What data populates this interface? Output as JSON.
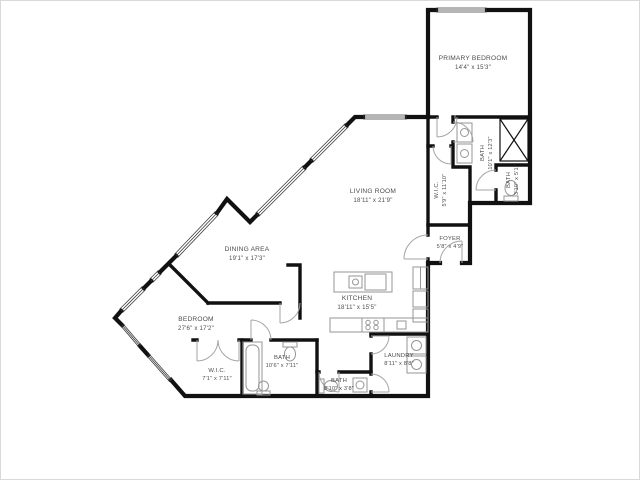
{
  "plan": {
    "title": "Condo floor plan",
    "rooms": {
      "primary_bedroom": {
        "name": "PRIMARY BEDROOM",
        "dims": "14'4\" x 15'3\""
      },
      "living_room": {
        "name": "LIVING ROOM",
        "dims": "18'11\" x 21'9\""
      },
      "dining_area": {
        "name": "DINING AREA",
        "dims": "19'1\" x 17'3\""
      },
      "kitchen": {
        "name": "KITCHEN",
        "dims": "18'11\" x 15'5\""
      },
      "bedroom": {
        "name": "BEDROOM",
        "dims": "27'6\" x 17'2\""
      },
      "foyer": {
        "name": "FOYER",
        "dims": "5'8\" x 4'9\""
      },
      "wic_primary": {
        "name": "W.I.C.",
        "dims": "5'9\" x 11'10\""
      },
      "bath_primary": {
        "name": "BATH",
        "dims": "10'1\" x 12'3\""
      },
      "bath_wc": {
        "name": "BATH",
        "dims": "3'10\" x 5'1\""
      },
      "wic_second": {
        "name": "W.I.C.",
        "dims": "7'1\" x 7'11\""
      },
      "bath_main": {
        "name": "BATH",
        "dims": "10'6\" x 7'11\""
      },
      "bath_hall": {
        "name": "BATH",
        "dims": "8'10\" x 3'8\""
      },
      "laundry": {
        "name": "LAUNDRY",
        "dims": "8'11\" x 8'8\""
      }
    },
    "colors": {
      "wall": "#111111",
      "window": "#3a3a3a",
      "door": "#a6a6a6",
      "fixture": "#969696",
      "text": "#4d4d4d",
      "background": "#ffffff"
    }
  }
}
